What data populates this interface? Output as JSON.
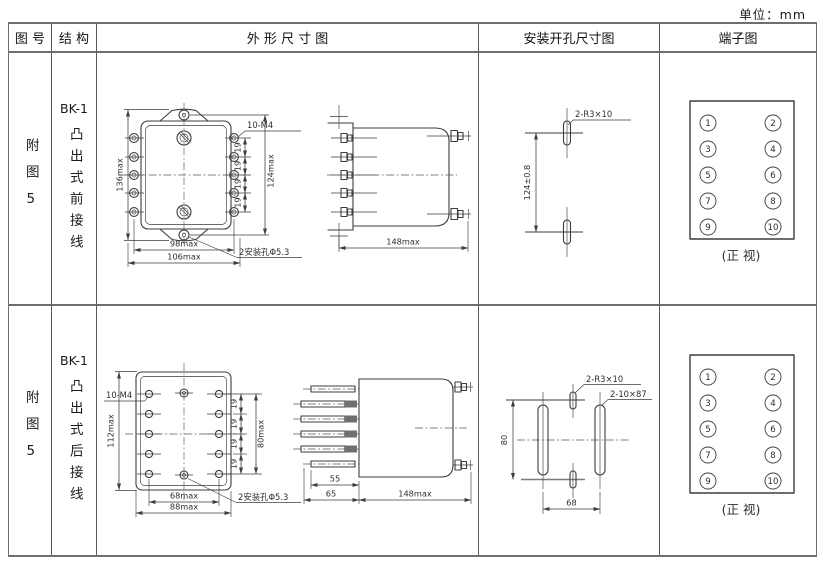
{
  "unit_label": "单位：mm",
  "ink_color": "#3d3d3d",
  "table_border_color": "#6f6f6f",
  "headers": {
    "figure": "图 号",
    "structure": "结 构",
    "outline": "外 形 尺 寸 图",
    "mounting": "安装开孔尺寸图",
    "terminal": "端子图"
  },
  "rows": [
    {
      "figure_no": "附图5",
      "model": "BK-1",
      "structure": "凸出式前接线",
      "outline": {
        "front": {
          "overall_height": "136max",
          "mount_height": "124max",
          "pitch": "19",
          "thread": "10-M4",
          "terminal_width": "98max",
          "overall_width": "106max",
          "mount_holes": "2安装孔Φ5.3"
        },
        "side": {
          "depth": "148max"
        }
      },
      "mounting": {
        "holes": "2-R3×10",
        "v_spacing": "124±0.8"
      },
      "terminal": {
        "left": [
          "1",
          "3",
          "5",
          "7",
          "9"
        ],
        "right": [
          "2",
          "4",
          "6",
          "8",
          "10"
        ],
        "caption": "(正 视)"
      }
    },
    {
      "figure_no": "附图5",
      "model": "BK-1",
      "structure": "凸出式后接线",
      "outline": {
        "front": {
          "overall_height": "112max",
          "mount_height": "80max",
          "pitch": "19",
          "thread": "10-M4",
          "terminal_width": "68max",
          "overall_width": "88max",
          "mount_holes": "2安装孔Φ5.3"
        },
        "side": {
          "stud_length": "55",
          "front_section": "65",
          "depth": "148max"
        }
      },
      "mounting": {
        "holes": "2-R3×10",
        "slots": "2-10×87",
        "v_spacing": "80",
        "h_spacing": "68"
      },
      "terminal": {
        "left": [
          "1",
          "3",
          "5",
          "7",
          "9"
        ],
        "right": [
          "2",
          "4",
          "6",
          "8",
          "10"
        ],
        "caption": "(正 视)"
      }
    }
  ]
}
